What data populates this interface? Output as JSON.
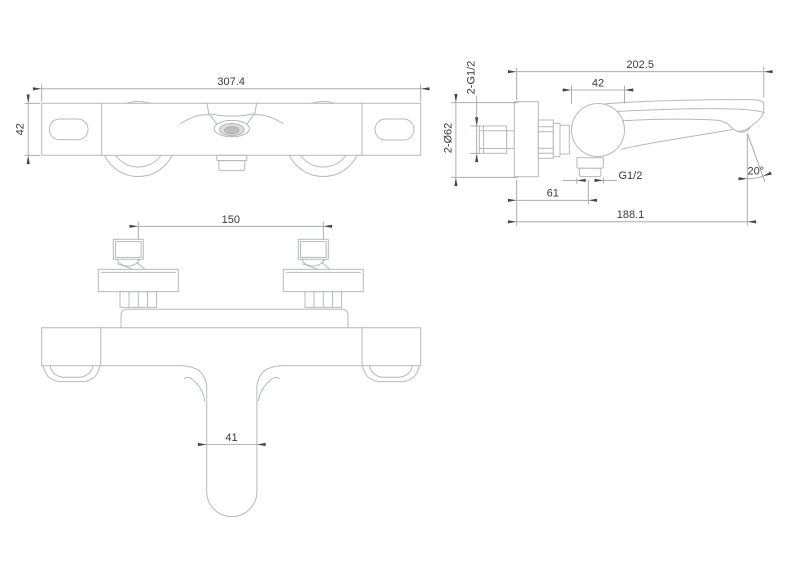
{
  "title": "Bath shower mixer technical drawing",
  "colors": {
    "background": "#ffffff",
    "part_line": "#b5b9bb",
    "dim_line": "#9aa0a3",
    "text": "#3a3a3a",
    "arrow": "#474747"
  },
  "views": {
    "front": {
      "label": "front-view",
      "dims": {
        "body_width": "307.4",
        "body_height": "42"
      }
    },
    "side": {
      "label": "side-view",
      "dims": {
        "overall_depth": "202.5",
        "inlet_threads": "2-G1/2",
        "body_diameter": "42",
        "escutcheon_diameter": "2-Ø62",
        "outlet_thread": "G1/2",
        "outlet_offset": "61",
        "spout_reach": "188.1",
        "spout_angle": "20°"
      }
    },
    "top": {
      "label": "top-view",
      "dims": {
        "inlet_centers": "150",
        "spout_width": "41"
      }
    }
  }
}
